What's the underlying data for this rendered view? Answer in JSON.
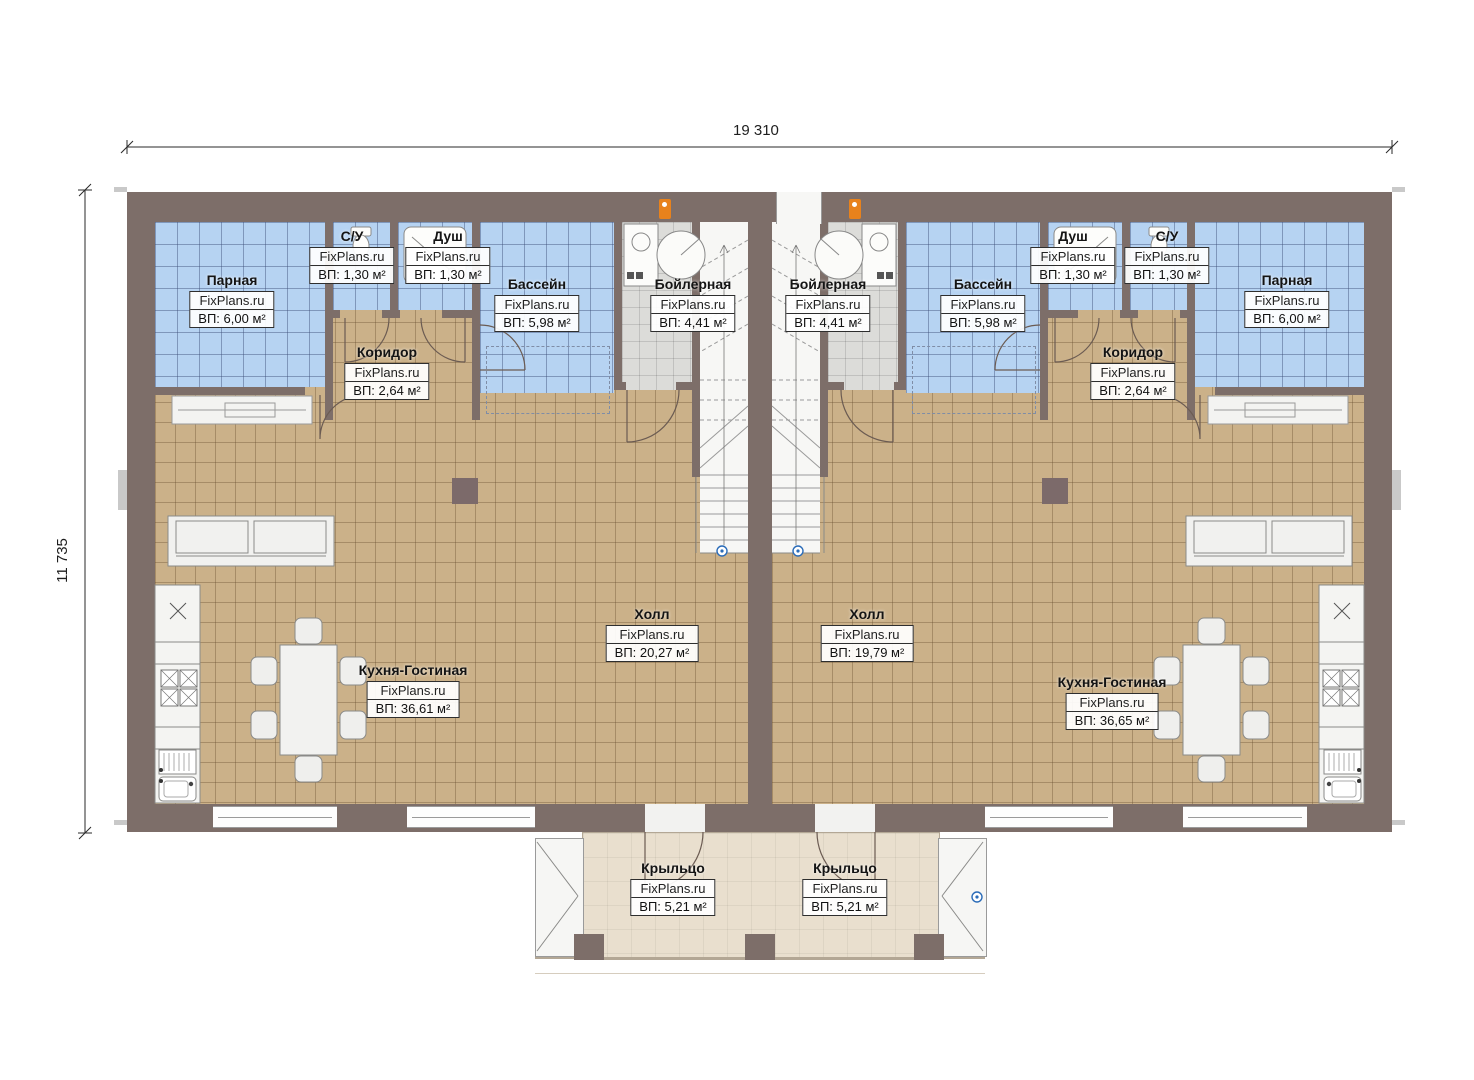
{
  "watermark": "FixPlans.ru",
  "dimensions": {
    "width_label": "19 310",
    "height_label": "11 735"
  },
  "rooms": {
    "parnaya_left": {
      "name": "Парная",
      "area": "ВП: 6,00 м²"
    },
    "su_left": {
      "name": "С/У",
      "area": "ВП: 1,30 м²"
    },
    "dush_left": {
      "name": "Душ",
      "area": "ВП: 1,30 м²"
    },
    "bassein_left": {
      "name": "Бассейн",
      "area": "ВП: 5,98 м²"
    },
    "boilernaya_left": {
      "name": "Бойлерная",
      "area": "ВП: 4,41 м²"
    },
    "koridor_left": {
      "name": "Коридор",
      "area": "ВП: 2,64 м²"
    },
    "holl_left": {
      "name": "Холл",
      "area": "ВП: 20,27 м²"
    },
    "kitchen_left": {
      "name": "Кухня-Гостиная",
      "area": "ВП: 36,61 м²"
    },
    "porch_left": {
      "name": "Крыльцо",
      "area": "ВП: 5,21 м²"
    },
    "boilernaya_right": {
      "name": "Бойлерная",
      "area": "ВП: 4,41 м²"
    },
    "bassein_right": {
      "name": "Бассейн",
      "area": "ВП: 5,98 м²"
    },
    "dush_right": {
      "name": "Душ",
      "area": "ВП: 1,30 м²"
    },
    "su_right": {
      "name": "С/У",
      "area": "ВП: 1,30 м²"
    },
    "parnaya_right": {
      "name": "Парная",
      "area": "ВП: 6,00 м²"
    },
    "koridor_right": {
      "name": "Коридор",
      "area": "ВП: 2,64 м²"
    },
    "holl_right": {
      "name": "Холл",
      "area": "ВП: 19,79 м²"
    },
    "kitchen_right": {
      "name": "Кухня-Гостиная",
      "area": "ВП: 36,65 м²"
    },
    "porch_right": {
      "name": "Крыльцо",
      "area": "ВП: 5,21 м²"
    }
  },
  "colors": {
    "wall": "#7d6e69",
    "floor_tile": "#cbb189",
    "wet_tile": "#b6d3f2",
    "boiler_tile": "#dcdcd9",
    "porch": "#e9dfce",
    "marker_orange": "#e8821c",
    "marker_blue": "#2b6cb8"
  }
}
